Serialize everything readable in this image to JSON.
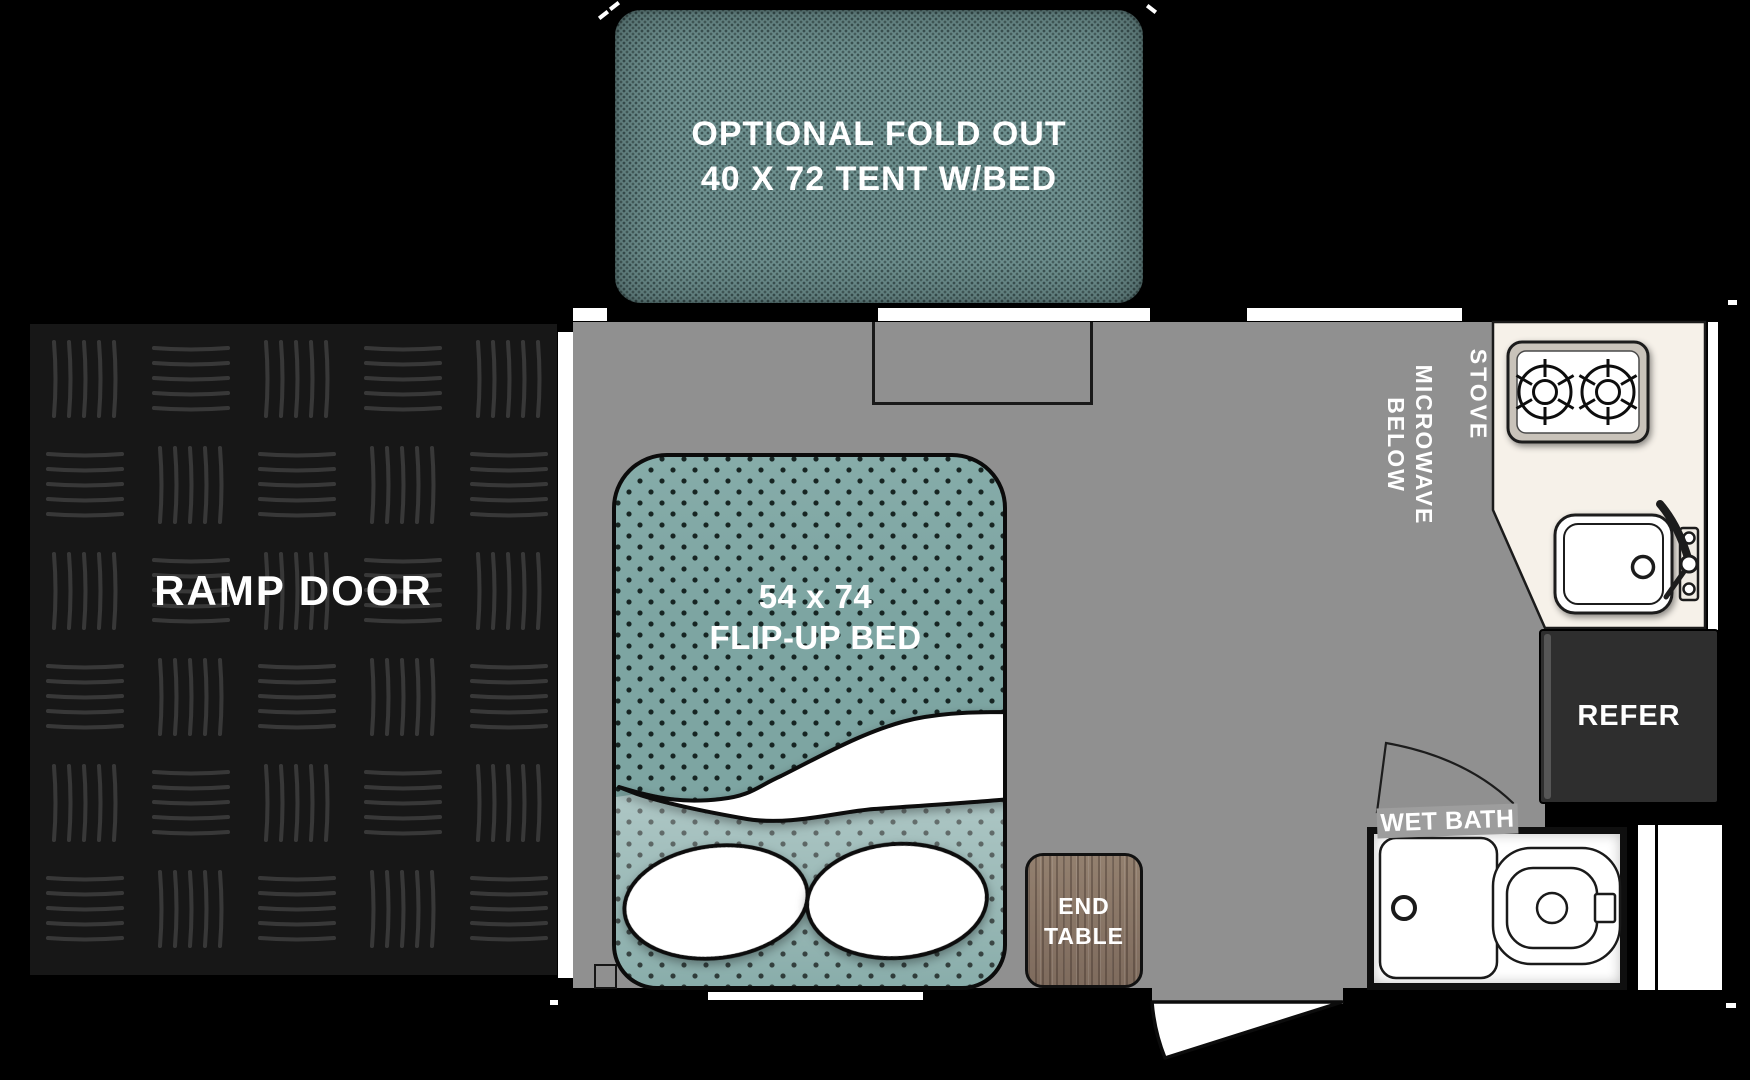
{
  "tent": {
    "line1": "OPTIONAL FOLD OUT",
    "line2": "40 X 72 TENT W/BED"
  },
  "ramp_door": {
    "label": "RAMP DOOR"
  },
  "bed": {
    "line1": "54 x 74",
    "line2": "FLIP-UP BED"
  },
  "end_table": {
    "line1": "END",
    "line2": "TABLE"
  },
  "kitchen": {
    "stove": "STOVE",
    "microwave_line1": "MICROWAVE",
    "microwave_line2": "BELOW"
  },
  "refrigerator": {
    "label": "REFER"
  },
  "wet_bath": {
    "label": "WET BATH"
  },
  "colors": {
    "background": "#000000",
    "floor_gray": "#909090",
    "tent_teal": "#6f9190",
    "bed_teal": "#7da5a2",
    "counter_cream": "#f6f1e9",
    "refer_dark": "#2e2e2e",
    "wood_brown": "#8b7668",
    "wall_white": "#ffffff",
    "outline_black": "#111111",
    "label_white": "#ffffff"
  }
}
